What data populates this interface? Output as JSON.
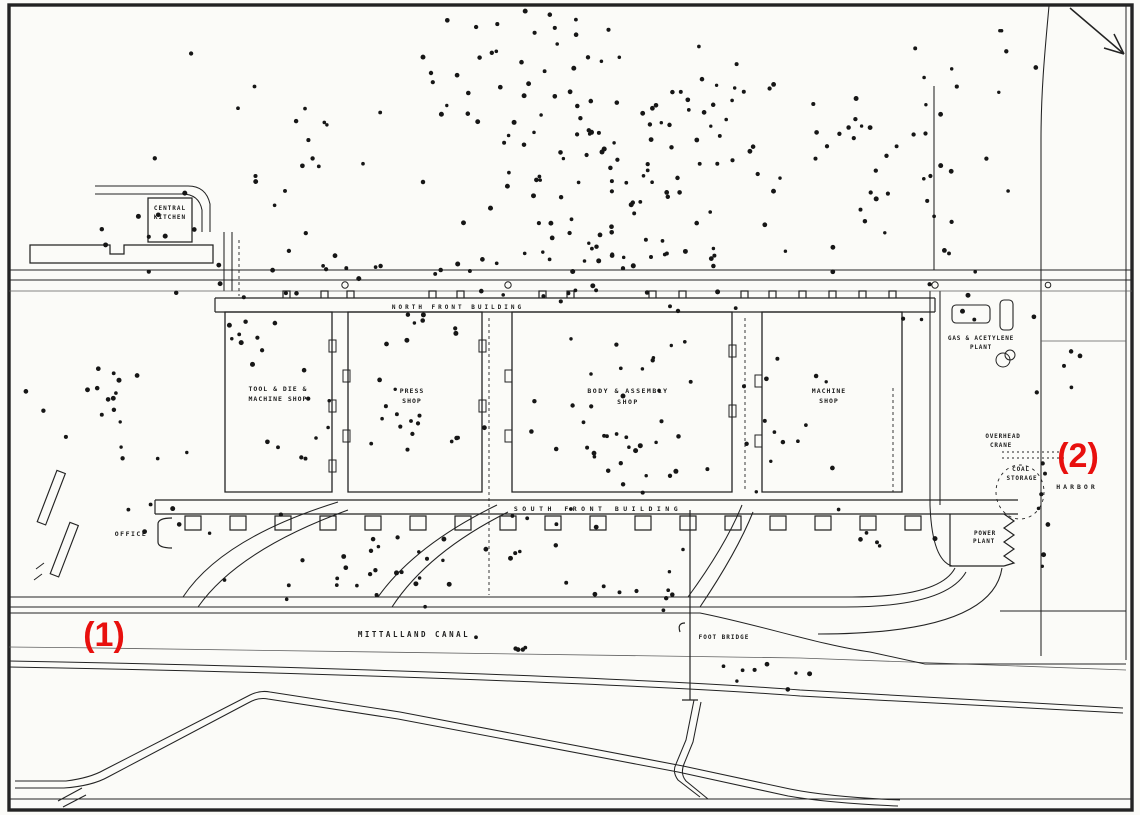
{
  "map_title": "factory-site-bomb-plot",
  "colors": {
    "ink": "#232323",
    "background": "#fbfbf8",
    "annotation_red": "#e8100e",
    "dot": "#161616"
  },
  "labels": {
    "central_kitchen": {
      "line1": "CENTRAL",
      "line2": "KITCHEN"
    },
    "tool_die": {
      "line1": "TOOL & DIE &",
      "line2": "MACHINE SHOP"
    },
    "press_shop": {
      "line1": "PRESS",
      "line2": "SHOP"
    },
    "body_assembly": {
      "line1": "BODY & ASSEMBLY",
      "line2": "SHOP"
    },
    "machine_shop": {
      "line1": "MACHINE",
      "line2": "SHOP"
    },
    "north_front": {
      "line1": "NORTH  FRONT  BUILDING"
    },
    "south_front": {
      "line1": "SOUTH  FRONT  BUILDING"
    },
    "gas_acetylene": {
      "line1": "GAS & ACETYLENE",
      "line2": "PLANT"
    },
    "overhead_crane": {
      "line1": "OVERHEAD",
      "line2": "CRANE"
    },
    "coal_storage": {
      "line1": "COAL",
      "line2": "STORAGE"
    },
    "harbor": {
      "line1": "HARBOR"
    },
    "power_plant": {
      "line1": "POWER",
      "line2": "PLANT"
    },
    "office": {
      "line1": "OFFICE"
    },
    "canal": {
      "line1": "MITTALLAND  CANAL"
    },
    "foot_bridge": {
      "line1": "FOOT BRIDGE"
    }
  },
  "annotations": {
    "a1": {
      "text": "(1)",
      "color": "#e8100e"
    },
    "a2": {
      "text": "(2)",
      "color": "#e8100e"
    }
  },
  "impact_dots": {
    "seed": 7,
    "radius": 2.1,
    "color": "#161616",
    "clusters": [
      [
        620,
        150,
        150,
        110,
        85
      ],
      [
        470,
        90,
        110,
        60,
        22
      ],
      [
        640,
        250,
        190,
        35,
        30
      ],
      [
        860,
        160,
        110,
        100,
        28
      ],
      [
        960,
        70,
        80,
        45,
        10
      ],
      [
        270,
        170,
        110,
        110,
        20
      ],
      [
        150,
        250,
        90,
        35,
        10
      ],
      [
        360,
        265,
        110,
        25,
        12
      ],
      [
        730,
        120,
        60,
        60,
        15
      ],
      [
        560,
        40,
        80,
        30,
        10
      ],
      [
        100,
        405,
        75,
        75,
        16
      ],
      [
        170,
        490,
        55,
        50,
        9
      ],
      [
        285,
        405,
        55,
        85,
        14
      ],
      [
        425,
        435,
        65,
        55,
        16
      ],
      [
        610,
        455,
        85,
        50,
        26
      ],
      [
        650,
        360,
        90,
        45,
        16
      ],
      [
        800,
        425,
        75,
        70,
        13
      ],
      [
        480,
        550,
        170,
        38,
        26
      ],
      [
        350,
        582,
        110,
        26,
        13
      ],
      [
        655,
        592,
        75,
        22,
        9
      ],
      [
        760,
        672,
        65,
        22,
        8
      ],
      [
        505,
        645,
        70,
        15,
        5
      ],
      [
        940,
        300,
        55,
        35,
        7
      ],
      [
        1058,
        360,
        35,
        55,
        6
      ],
      [
        875,
        532,
        55,
        25,
        5
      ],
      [
        230,
        322,
        35,
        25,
        6
      ],
      [
        1044,
        478,
        6,
        70,
        7
      ],
      [
        590,
        300,
        120,
        18,
        10
      ],
      [
        445,
        325,
        60,
        20,
        8
      ],
      [
        965,
        205,
        45,
        55,
        8
      ]
    ]
  }
}
